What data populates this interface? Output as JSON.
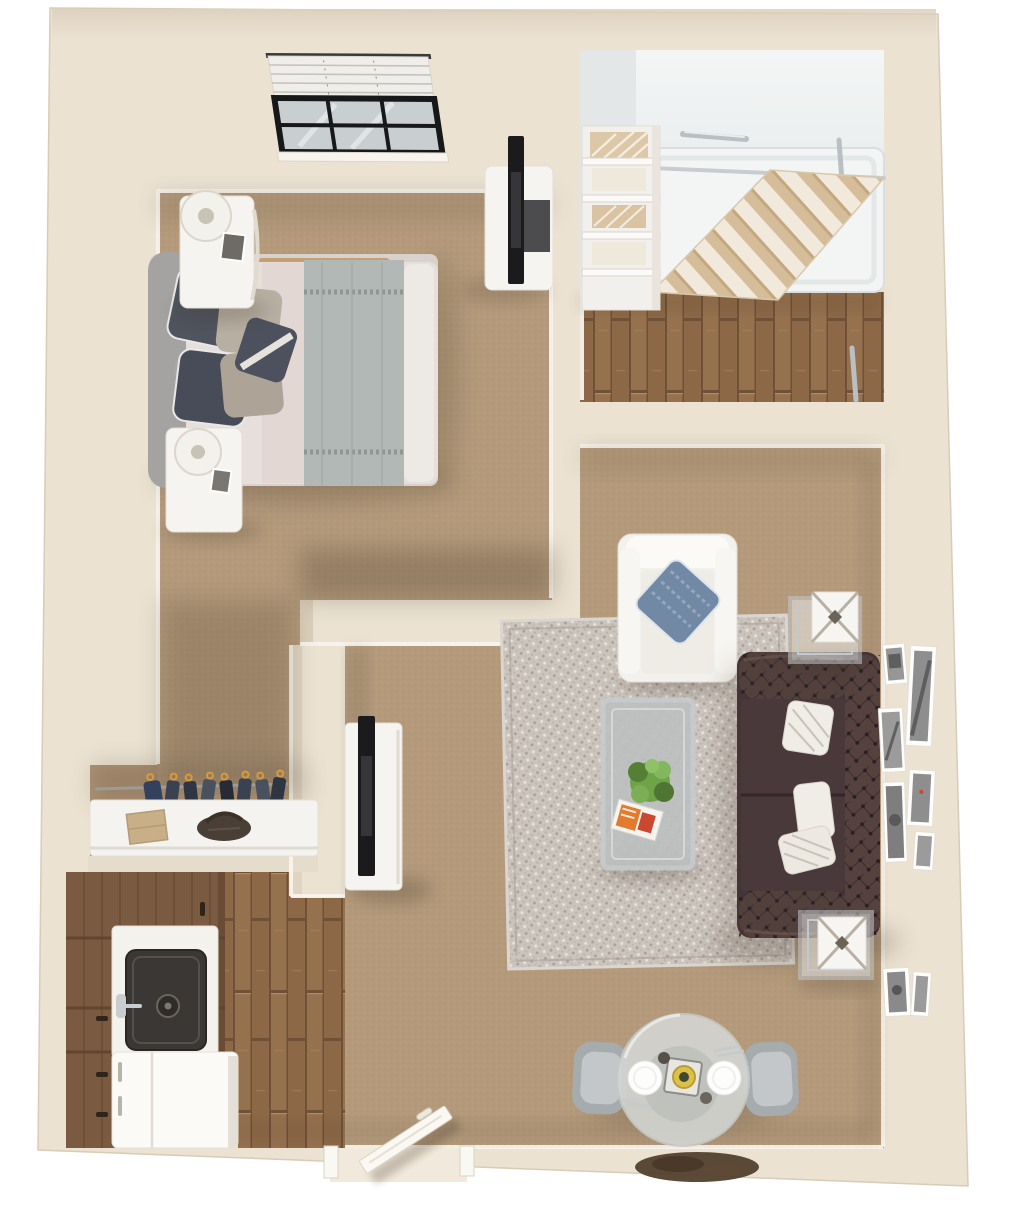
{
  "scene": {
    "kind": "3d-floor-plan-rendering",
    "unit": "one-bedroom-apartment",
    "view": "top-down"
  },
  "palette": {
    "page_bg": "#FFFFFF",
    "wall": "#EBE2D2",
    "wall_dark": "#DBCFBA",
    "baseboard": "#F8F4EC",
    "carpet": "#B49A7B",
    "wood": "#96714E",
    "wood_dark": "#6F5137",
    "rug_base": "#CBC4BD",
    "rug_accent": "#ABA29B",
    "shower_wall": "#E9ECEC",
    "shower_pan": "#F3F5F5",
    "chrome": "#B9BFC3",
    "curtain_tan": "#D5BD9A",
    "curtain_cream": "#F1E9DC",
    "white_furniture": "#F6F4F0",
    "sofa": "#463538",
    "sofa_arm": "#55423F",
    "pillow_white": "#F0EDE7",
    "armchair": "#F3F1ED",
    "pillow_blue": "#7189A5",
    "headboard": "#A5A3A1",
    "duvet": "#E7DFDB",
    "sheet_pink": "#E0D0CC",
    "throw_gray": "#B2B8B5",
    "pillow_dark": "#4C515D",
    "pillow_greige": "#B4AC9F",
    "bed_rail": "#C59E74",
    "clothes_navy": "#3A4252",
    "hanger_orange": "#D89A3F",
    "cabinet_brown": "#7A5A40",
    "counter_white": "#F4F2ED",
    "sink_dark": "#3B3734",
    "fridge_white": "#FBFAF7",
    "glass_table": "#D4D7D4",
    "chair_gray": "#A6ABAE",
    "plate_white": "#FDFDFC",
    "doormat_brown": "#53402E",
    "door_white": "#FAF8F3",
    "plant_green": "#6FA348",
    "magazine_orange": "#E07B2F",
    "photo_gray": "#969696",
    "tv_black": "#1B1B1D",
    "lamp_white": "#F3F1EC",
    "box_tan": "#C8AF88",
    "purse_brown": "#4A3F36",
    "shadow": "#3E3020"
  },
  "rooms": {
    "bedroom": {
      "floor": "carpet",
      "items": [
        "queen-bed",
        "upholstered-headboard",
        "accent-pillows",
        "gray-throw-blanket",
        "nightstand-with-lamp-top",
        "nightstand-with-lamp-bottom",
        "tv-dresser",
        "flat-screen-tv",
        "window-with-venetian-blinds"
      ]
    },
    "bathroom": {
      "floor": "hardwood",
      "items": [
        "walk-in-shower",
        "shower-pan-with-drain",
        "striped-shower-curtain",
        "curtain-rod",
        "grab-bar-top",
        "grab-bar-side",
        "grab-bar-entry",
        "towel-shelving-unit"
      ]
    },
    "closet": {
      "floor": "carpet",
      "items": [
        "hanging-rod",
        "hanging-clothes",
        "storage-counter",
        "cardboard-box",
        "handbag"
      ]
    },
    "kitchen": {
      "floor": "hardwood",
      "items": [
        "cabinet-run",
        "countertop",
        "sink-with-faucet",
        "refrigerator"
      ]
    },
    "living_room": {
      "floor": "carpet",
      "items": [
        "patterned-area-rug",
        "chesterfield-sofa",
        "throw-pillows",
        "white-armchair",
        "blue-accent-pillow",
        "coffee-table-with-plant-and-magazine",
        "side-table-north",
        "side-table-south",
        "decor-cube-lanterns",
        "tv-console",
        "flat-screen-tv",
        "gallery-picture-frames"
      ]
    },
    "dining_area": {
      "floor": "carpet",
      "items": [
        "round-glass-table",
        "dining-chairs",
        "place-settings",
        "centerpiece",
        "entry-door",
        "doormat"
      ]
    }
  },
  "counts": {
    "picture_frames": 8,
    "closet_hangers": 8,
    "dining_chairs": 2,
    "plates": 2,
    "grab_bars": 3,
    "towel_stacks": 4,
    "window_panes": 6,
    "sofa_pillows": 3
  }
}
